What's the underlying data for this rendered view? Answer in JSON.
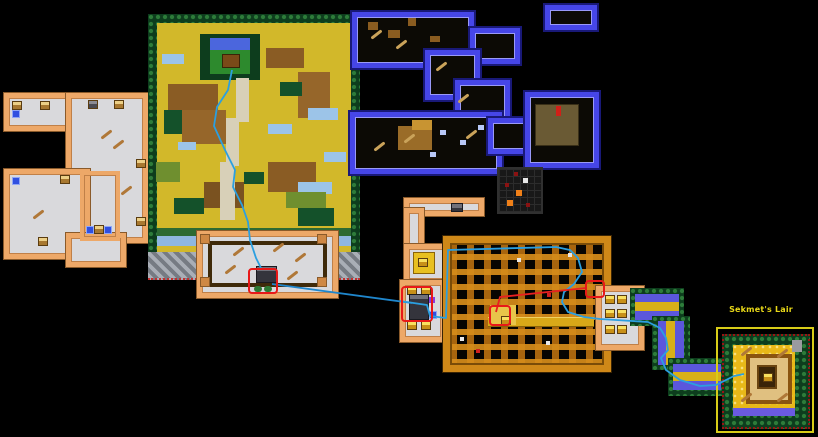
{
  "canvas": {
    "width": 818,
    "height": 437,
    "background": "#000000"
  },
  "labels": {
    "sekmets_lair": "Sekmet's Lair"
  },
  "palette": {
    "route_line_blue": "#2b9fe0",
    "route_line_red": "#e82020",
    "highlight_box_red": "#e81818",
    "peach_wall": "#eda868",
    "dungeon_floor": "#d9d9dc",
    "blue_wall": "#4646e8",
    "maze_gold": "#cf8818",
    "tree_green": "#2e7c3a",
    "overworld_ground": "#d2b82a",
    "water_blue": "#9cc4e8",
    "rock_gray": "#8f949c",
    "lair_ground": "#e8b818",
    "lair_box_yellow": "#d8cc18",
    "label_yellow": "#e8d818",
    "marker_orange": "#f08018"
  },
  "regions": [
    {
      "id": "west-dungeon",
      "kind": "dungeon-map"
    },
    {
      "id": "overworld",
      "kind": "overworld-map"
    },
    {
      "id": "northeast-dungeon",
      "kind": "dungeon-map"
    },
    {
      "id": "puzzle-room",
      "kind": "mini-map"
    },
    {
      "id": "great-hall",
      "kind": "room-map"
    },
    {
      "id": "gold-maze-dungeon",
      "kind": "dungeon-map"
    },
    {
      "id": "forest-path",
      "kind": "path-map"
    },
    {
      "id": "sekmets-lair",
      "kind": "boss-map"
    }
  ]
}
